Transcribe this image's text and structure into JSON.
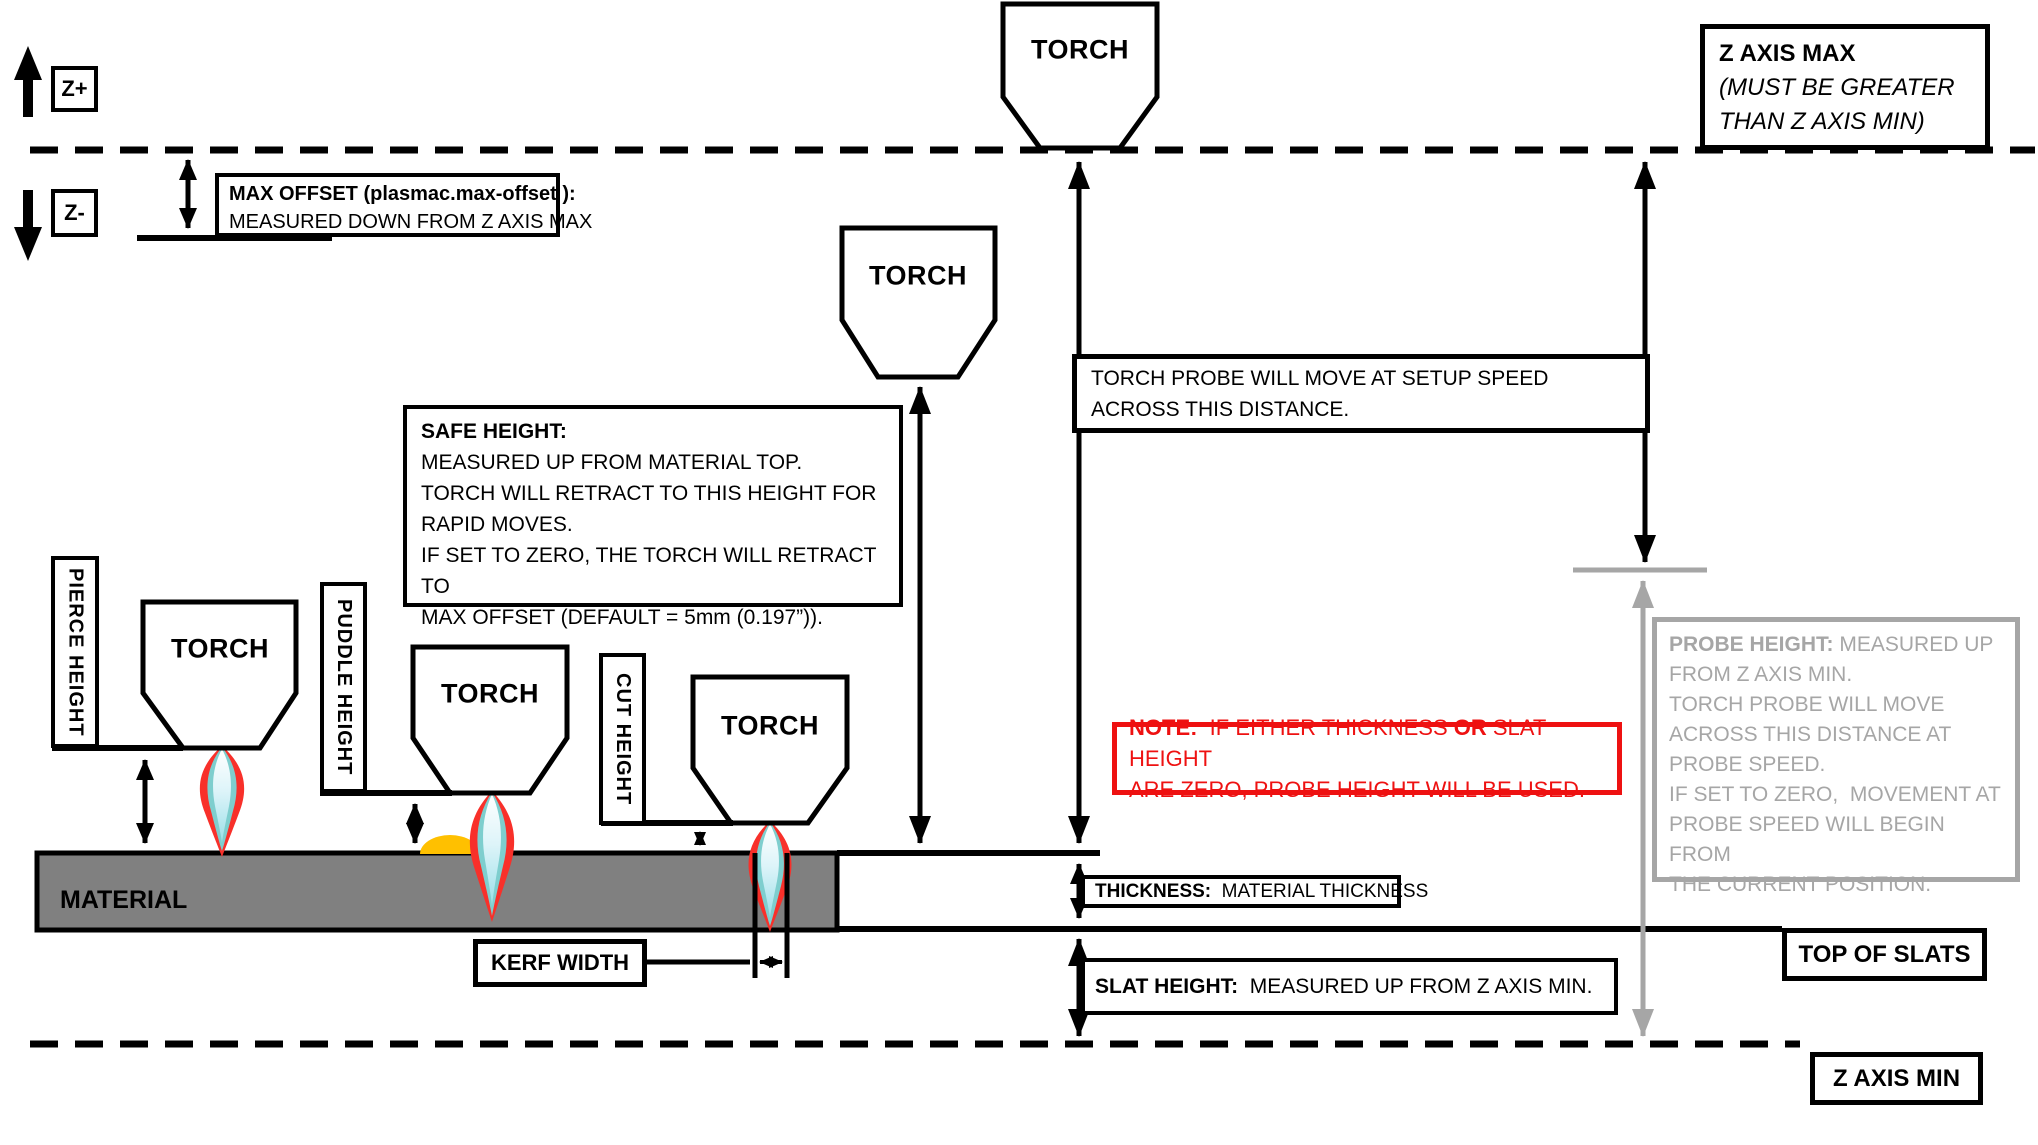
{
  "colors": {
    "line_black": "#000000",
    "probe_gray": "#A6A6A6",
    "note_red": "#EE1111",
    "material_gray": "#808080",
    "puddle_orange": "#FFC000",
    "flame_outer_red": "#F8302A",
    "flame_mid_teal": "#7ECECE"
  },
  "axis": {
    "z_plus": "Z+",
    "z_minus": "Z-"
  },
  "torch": {
    "label": "TORCH"
  },
  "max_offset": {
    "title": "MAX OFFSET (plasmac.max-offset ):",
    "line2": "MEASURED DOWN FROM Z AXIS MAX"
  },
  "z_axis_max": {
    "title": "Z AXIS MAX",
    "line2": "(MUST BE GREATER",
    "line3": "THAN Z AXIS MIN)"
  },
  "safe_height": {
    "title": "SAFE HEIGHT:",
    "lines": [
      "MEASURED UP FROM MATERIAL TOP.",
      "TORCH WILL RETRACT TO THIS HEIGHT FOR",
      "RAPID MOVES.",
      "IF SET TO ZERO, THE TORCH WILL RETRACT TO",
      "MAX OFFSET (DEFAULT = 5mm (0.197”))."
    ]
  },
  "torch_probe": {
    "line1": "TORCH PROBE WILL MOVE AT SETUP SPEED",
    "line2": "ACROSS THIS DISTANCE."
  },
  "probe_height": {
    "title": "PROBE HEIGHT:",
    "title_rest": " MEASURED UP",
    "lines": [
      "FROM Z AXIS MIN.",
      "TORCH PROBE WILL MOVE",
      "ACROSS THIS DISTANCE AT",
      "PROBE SPEED.",
      "IF SET TO ZERO,  MOVEMENT AT",
      "PROBE SPEED WILL BEGIN FROM",
      "THE CURRENT POSITION."
    ]
  },
  "note": {
    "bold_intro": "NOTE:",
    "text_a": "  IF EITHER THICKNESS ",
    "bold_or": "OR",
    "text_b": " SLAT HEIGHT",
    "line2": "ARE ZERO, PROBE HEIGHT WILL BE USED."
  },
  "labels": {
    "pierce_height": "PIERCE HEIGHT",
    "puddle_height": "PUDDLE HEIGHT",
    "cut_height": "CUT HEIGHT",
    "kerf_width": "KERF WIDTH",
    "material": "MATERIAL",
    "top_of_slats": "TOP OF SLATS",
    "z_axis_min": "Z AXIS MIN"
  },
  "thickness": {
    "title": "THICKNESS:",
    "rest": "  MATERIAL THICKNESS"
  },
  "slat_height": {
    "title": "SLAT HEIGHT:",
    "rest": "  MEASURED UP FROM Z AXIS MIN."
  }
}
